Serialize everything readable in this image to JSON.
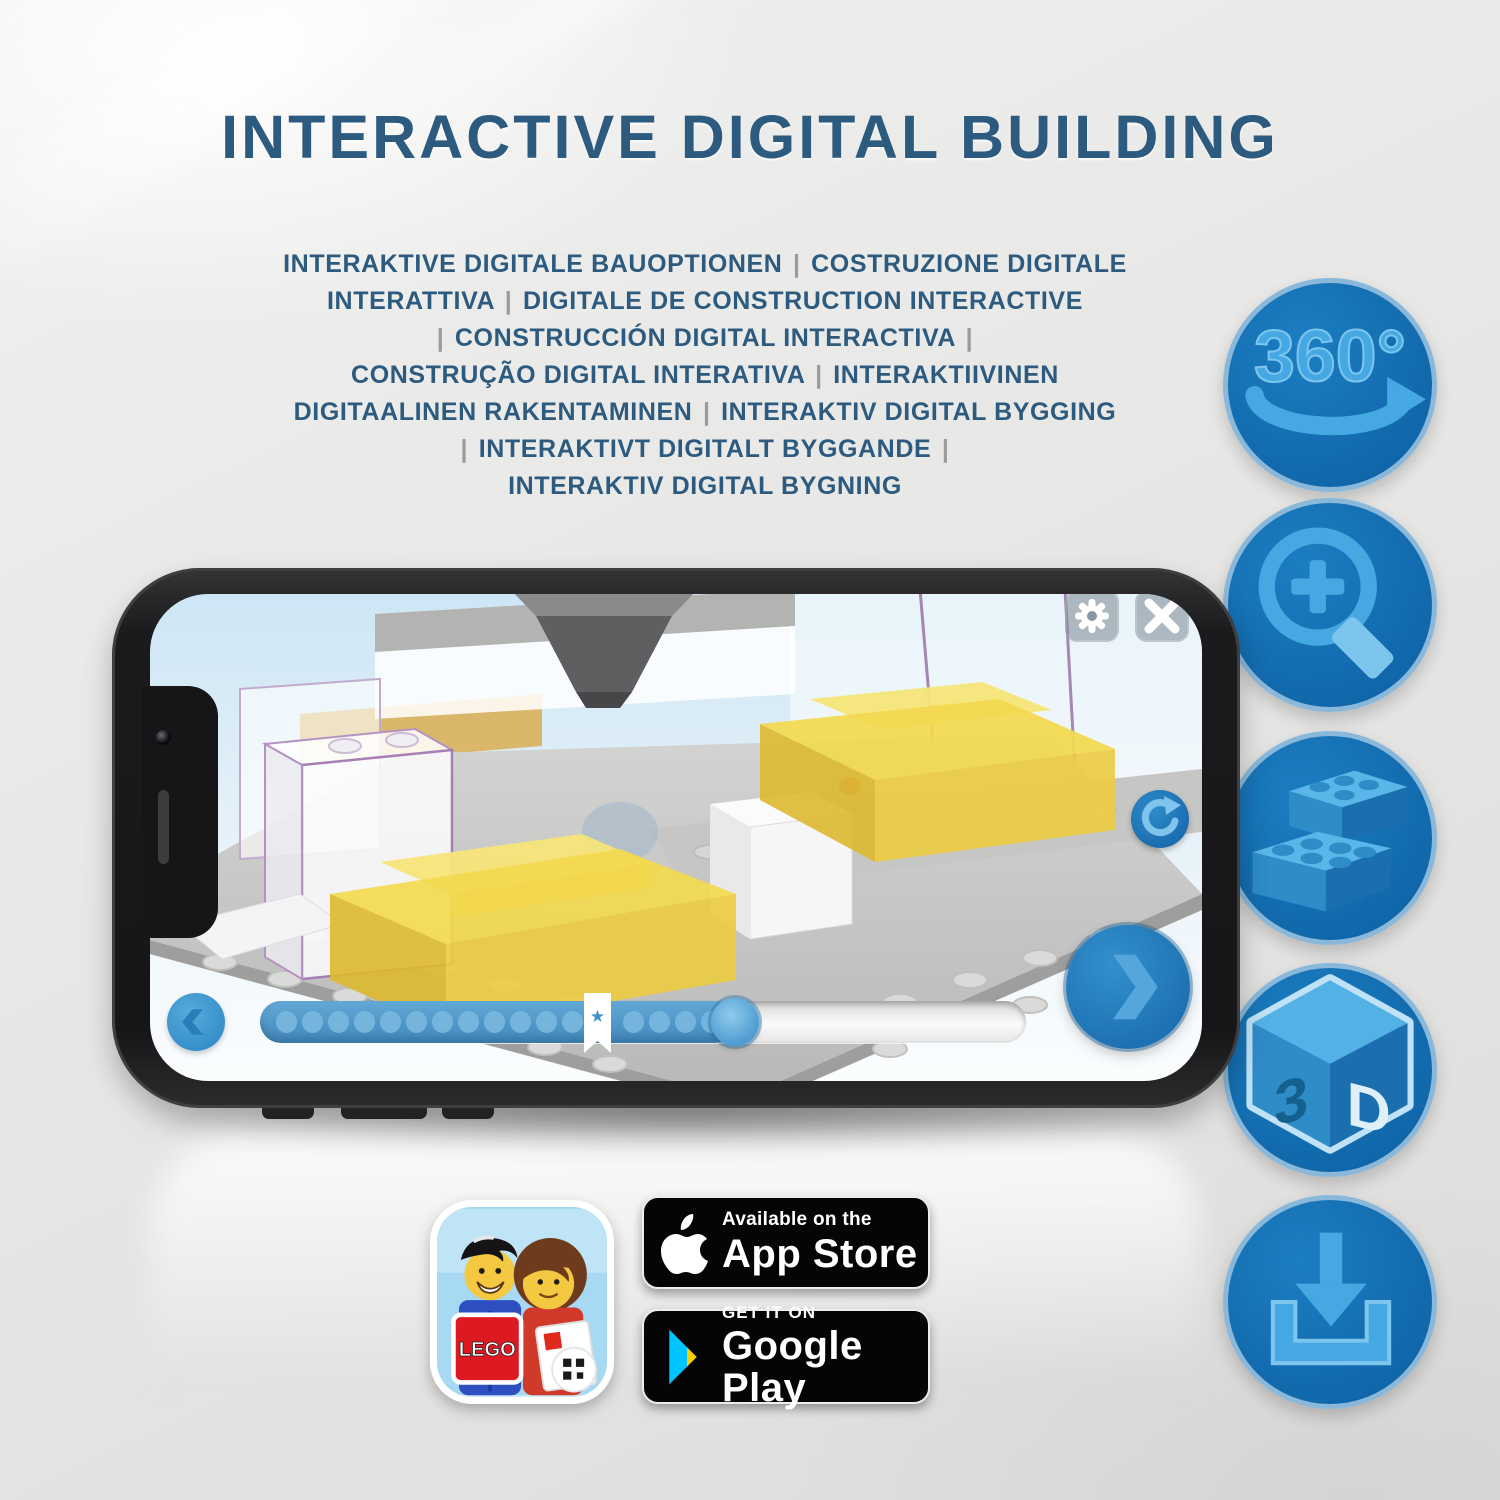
{
  "header": {
    "title": "INTERACTIVE DIGITAL BUILDING",
    "subtitle_lines": [
      "INTERAKTIVE DIGITALE BAUOPTIONEN | COSTRUZIONE DIGITALE",
      "INTERATTIVA | DIGITALE DE CONSTRUCTION INTERACTIVE",
      "| CONSTRUCCIÓN DIGITAL INTERACTIVA |",
      "CONSTRUÇÃO DIGITAL INTERATIVA | INTERAKTIIVINEN",
      "DIGITAALINEN RAKENTAMINEN | INTERAKTIV DIGITAL BYGGING",
      "| INTERAKTIVT DIGITALT BYGGANDE |",
      "INTERAKTIV DIGITAL BYGNING"
    ]
  },
  "feature_icons": {
    "rotation_label": "360°",
    "cube_left": "3",
    "cube_right": "D",
    "items": [
      "360-degree-rotation",
      "zoom-in",
      "brick-placement",
      "3d-view",
      "download"
    ]
  },
  "app_ui": {
    "progress": {
      "fill_percent": 62,
      "marker_percent": 44,
      "dots_before_marker": 12,
      "dots_after_marker": 4,
      "bookmark_glyph": "★"
    }
  },
  "badges": {
    "app_store": {
      "line1": "Available on the",
      "line2": "App Store"
    },
    "google_play": {
      "line1": "GET IT ON",
      "line2": "Google Play"
    },
    "lego_app": {
      "logo_text": "LEGO"
    }
  },
  "colors": {
    "title_blue": "#2d5a7f",
    "circle_blue": "#1471b5",
    "glyph_blue": "#41a3de",
    "lego_yellow": "#f3d94e"
  }
}
